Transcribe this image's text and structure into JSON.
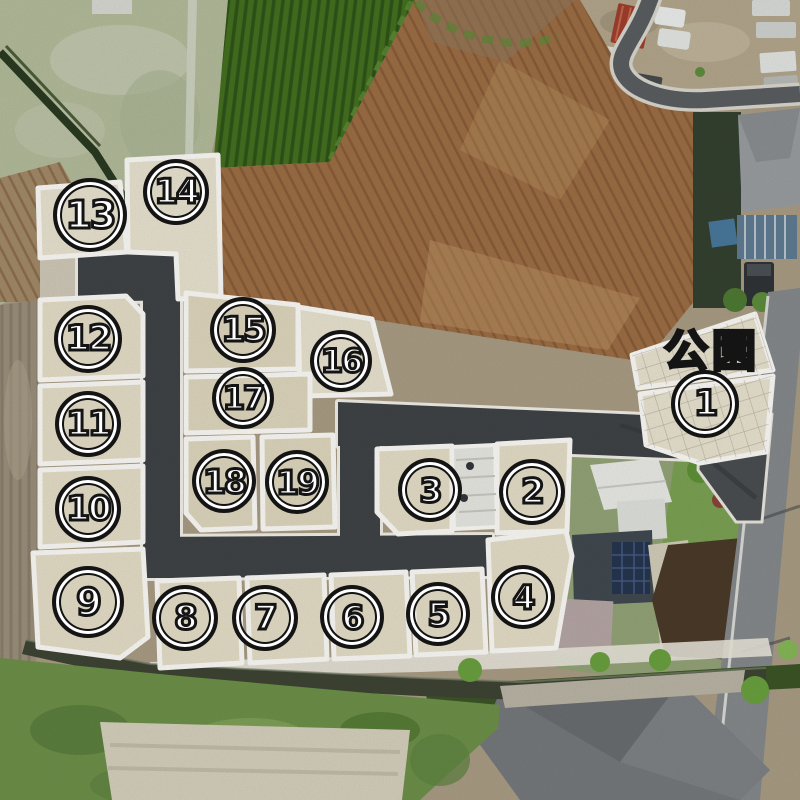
{
  "map": {
    "type": "land-lot-aerial-map",
    "park": {
      "label": "公園",
      "x": 712,
      "y": 347
    },
    "lots": [
      {
        "id": 1,
        "label": "1",
        "x": 705,
        "y": 404,
        "size": 68
      },
      {
        "id": 2,
        "label": "2",
        "x": 532,
        "y": 492,
        "size": 66
      },
      {
        "id": 3,
        "label": "3",
        "x": 430,
        "y": 490,
        "size": 64
      },
      {
        "id": 4,
        "label": "4",
        "x": 523,
        "y": 597,
        "size": 64
      },
      {
        "id": 5,
        "label": "5",
        "x": 438,
        "y": 614,
        "size": 64
      },
      {
        "id": 6,
        "label": "6",
        "x": 352,
        "y": 617,
        "size": 64
      },
      {
        "id": 7,
        "label": "7",
        "x": 265,
        "y": 618,
        "size": 66
      },
      {
        "id": 8,
        "label": "8",
        "x": 185,
        "y": 618,
        "size": 66
      },
      {
        "id": 9,
        "label": "9",
        "x": 88,
        "y": 602,
        "size": 72
      },
      {
        "id": 10,
        "label": "10",
        "x": 88,
        "y": 509,
        "size": 66
      },
      {
        "id": 11,
        "label": "11",
        "x": 88,
        "y": 424,
        "size": 66
      },
      {
        "id": 12,
        "label": "12",
        "x": 88,
        "y": 339,
        "size": 68
      },
      {
        "id": 13,
        "label": "13",
        "x": 90,
        "y": 215,
        "size": 74
      },
      {
        "id": 14,
        "label": "14",
        "x": 176,
        "y": 192,
        "size": 66
      },
      {
        "id": 15,
        "label": "15",
        "x": 243,
        "y": 330,
        "size": 66
      },
      {
        "id": 16,
        "label": "16",
        "x": 341,
        "y": 361,
        "size": 62
      },
      {
        "id": 17,
        "label": "17",
        "x": 243,
        "y": 398,
        "size": 62
      },
      {
        "id": 18,
        "label": "18",
        "x": 224,
        "y": 481,
        "size": 64
      },
      {
        "id": 19,
        "label": "19",
        "x": 297,
        "y": 482,
        "size": 64
      }
    ],
    "colors": {
      "road": "#3f4346",
      "lot_fill": "#e4ddc7",
      "boundary_line": "#fbfaf6",
      "marker_ring": "#141414",
      "marker_text": "#ffffff",
      "dirt_field": "#9c6e45",
      "crop_field": "#447020",
      "water_channel": "#3e4434"
    }
  }
}
